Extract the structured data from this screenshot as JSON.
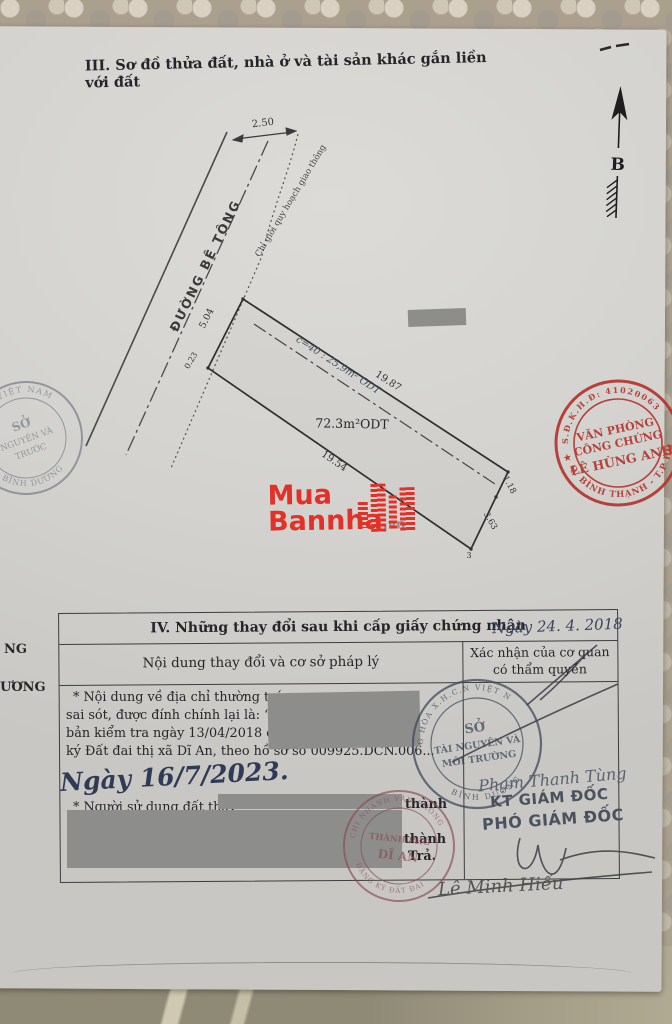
{
  "document": {
    "section3_title": "III. Sơ đồ thửa đất, nhà ở và tài sản khác gắn liền với đất",
    "north_label": "B"
  },
  "diagram": {
    "road_label": "ĐƯỜNG BÊ TÔNG",
    "planning_label": "Chỉ giới quy hoạch giao thông",
    "area_label": "72.3m²ODT",
    "handwritten_note": "c=40 : 25,9m² ODT",
    "dims": {
      "top_width": "2.50",
      "frontage": "5.04",
      "frontage_small": "0.23",
      "side_top": "19.87",
      "side_bottom": "19.54",
      "right_upper": "1.18",
      "right_lower": "3.63",
      "corner_label": "3"
    }
  },
  "watermark": {
    "line1": "Mua",
    "line2": "Bannha",
    "suffix": ".vn"
  },
  "stamps": {
    "left_partial": {
      "arc_top": "X.H.C.N VIỆT NAM",
      "line1": "SỞ",
      "line2": "NGUYÊN VÀ",
      "line3": "TRƯỚC",
      "arc_bottom": "BÌNH DƯƠNG"
    },
    "notary": {
      "arc_top": "S.Đ.K.H.Đ: 41020063",
      "line1": "VĂN PHÒNG",
      "line2": "CÔNG CHỨNG",
      "line3": "LÊ HÙNG ANH",
      "arc_bottom": "Q. BÌNH THẠNH - T.P HỒ",
      "star": "★"
    },
    "department": {
      "arc_top": "G HÒA X.H.C.N VIỆT N",
      "line1": "SỞ",
      "line2": "TÀI NGUYÊN VÀ",
      "line3": "MÔI TRƯỜNG",
      "arc_bottom": "BÌNH DƯƠNG"
    },
    "branch": {
      "arc_top": "CHI NHÁNH VĂN PHÒNG",
      "arc_bottom": "ĐĂNG KÝ ĐẤT ĐAI",
      "line1": "THÀNH PHỐ",
      "line2": "DĨ AN"
    }
  },
  "section4": {
    "title": "IV. Những thay đổi sau khi cấp giấy chứng nhận",
    "handwritten_date": "Ngày 24. 4. 2018",
    "columns": {
      "left": "Nội dung thay đổi và cơ sở pháp lý",
      "right_line1": "Xác nhận của cơ quan",
      "right_line2": "có thẩm quyền"
    },
    "body_lines": [
      "* Nội dung về địa chỉ thường trú:",
      "sai sót, được đính chính lại là: “T",
      "bản kiểm tra ngày 13/04/2018 củ",
      "ký Đất đai thị xã Dĩ An, theo hồ sơ số 009925.DCN.006..."
    ],
    "handwritten_date2": "Ngày 16/7/2023.",
    "change_line": "* Người sử dụng đất thay",
    "fragment_thanh1": "thành",
    "fragment_thanh2": "thành",
    "fragment_tra": "Trả.",
    "approver": {
      "name": "Phạm Thanh Tùng",
      "title1": "KT GIÁM ĐỐC",
      "title2": "PHÓ GIÁM ĐỐC"
    },
    "signer": "Lê Minh Hiếu"
  },
  "edge_fragments": {
    "f1": "NG",
    "f2": "ƯƠNG"
  }
}
